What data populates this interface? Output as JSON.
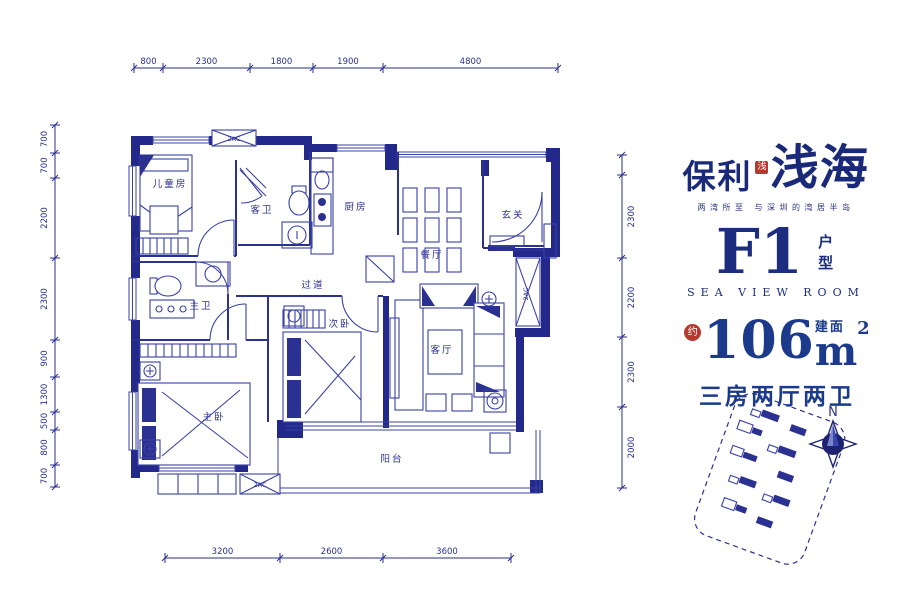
{
  "brand": {
    "name_left": "保利",
    "seal": "浅",
    "name_right": "浅海",
    "tagline": "两湾所至 与深圳的湾居半岛"
  },
  "unit": {
    "code": "F1",
    "code_suffix": "户型",
    "subtitle": "SEA VIEW ROOM"
  },
  "area": {
    "approx": "约",
    "value": "106",
    "build_label": "建面",
    "unit": "m",
    "power": "2",
    "layout": "三房两厅两卫"
  },
  "compass_north": "N",
  "dims": {
    "top": [
      "800",
      "2300",
      "1800",
      "1900",
      "4800"
    ],
    "bottom": [
      "3200",
      "2600",
      "3600"
    ],
    "left": [
      "700",
      "700",
      "2200",
      "2300",
      "900",
      "1300",
      "500",
      "800",
      "700"
    ],
    "right": [
      "2300",
      "2200",
      "2300",
      "2000"
    ]
  },
  "rooms": {
    "children_room": "儿童房",
    "guest_bath": "客卫",
    "kitchen": "厨房",
    "foyer": "玄关",
    "dining": "餐厅",
    "hallway": "过道",
    "master_bath": "主卫",
    "master_bed": "主卧",
    "second_bed": "次卧",
    "living": "客厅",
    "balcony": "阳台"
  },
  "shaft_labels": {
    "ac_top": "2AC",
    "ac_right": "2AC",
    "ac_bottom": "2AC"
  },
  "colors": {
    "wall": "#23298b",
    "line": "#3a41a5",
    "text": "#232d7d",
    "accent_red": "#b43a2f"
  }
}
